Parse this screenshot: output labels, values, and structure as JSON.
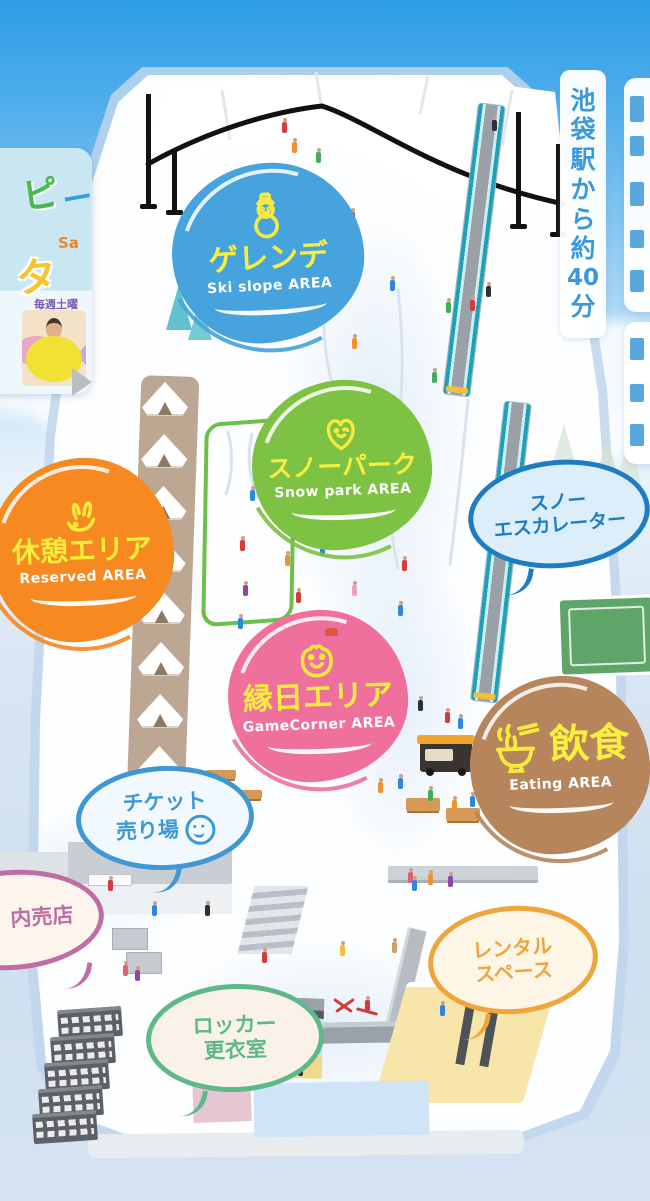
{
  "title": "snow-park-map",
  "signs": {
    "station": {
      "text": "池袋駅から約40分",
      "color": "#3b99d8"
    }
  },
  "areas": [
    {
      "name": "gelande",
      "jp": "ゲレンデ",
      "en": "Ski slope AREA",
      "color": "#47A3DE",
      "icon": "snowman-icon"
    },
    {
      "name": "snow-park",
      "jp": "スノーパーク",
      "en": "Snow park AREA",
      "color": "#7DC243",
      "icon": "heart-face-icon"
    },
    {
      "name": "rest-area",
      "jp": "休憩エリア",
      "en": "Reserved AREA",
      "color": "#F6891F",
      "icon": "rabbit-icon"
    },
    {
      "name": "ennichi-area",
      "jp": "縁日エリア",
      "en": "GameCorner AREA",
      "color": "#F0709D",
      "icon": "frog-icon"
    },
    {
      "name": "eating-area",
      "jp": "飲食",
      "en": "Eating AREA",
      "color": "#B6855C",
      "icon": "ramen-icon"
    }
  ],
  "bubbles": {
    "escalator": {
      "line1": "スノー",
      "line2": "エスカレーター",
      "color": "#1E7CC3",
      "fill": "#ddeefb"
    },
    "ticket": {
      "line1": "チケット",
      "line2": "売り場",
      "color": "#3F97D3",
      "fill": "#f2f9fe",
      "icon": "smiley-icon"
    },
    "shop": {
      "line1": "内売店",
      "color": "#C06DA6",
      "fill": "#fcf5ed"
    },
    "rental": {
      "line1": "レンタル",
      "line2": "スペース",
      "color": "#EFA43C",
      "fill": "#fdf6e7"
    },
    "locker": {
      "line1": "ロッカー",
      "line2": "更衣室",
      "color": "#5EB889",
      "fill": "#faf2e8"
    }
  },
  "poster": {
    "fragments": {
      "f1": "ピ",
      "f2": "タテ",
      "f3": "Sa",
      "f4": "毎週土曜"
    },
    "next_arrow": "▶"
  },
  "icon_colors": {
    "area_icon_stroke": "#F7EA3C"
  }
}
